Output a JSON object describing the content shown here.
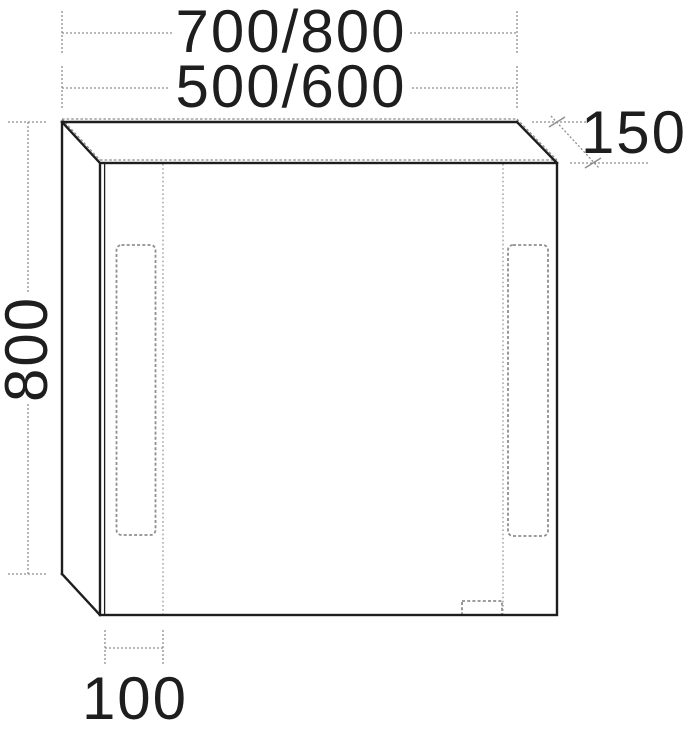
{
  "labels": {
    "width_primary": "700/800",
    "width_secondary": "500/600",
    "height": "800",
    "depth": "150",
    "offset": "100"
  },
  "colors": {
    "line": "#1e1e1e",
    "dim": "#8e8e8e",
    "background": "#ffffff"
  }
}
